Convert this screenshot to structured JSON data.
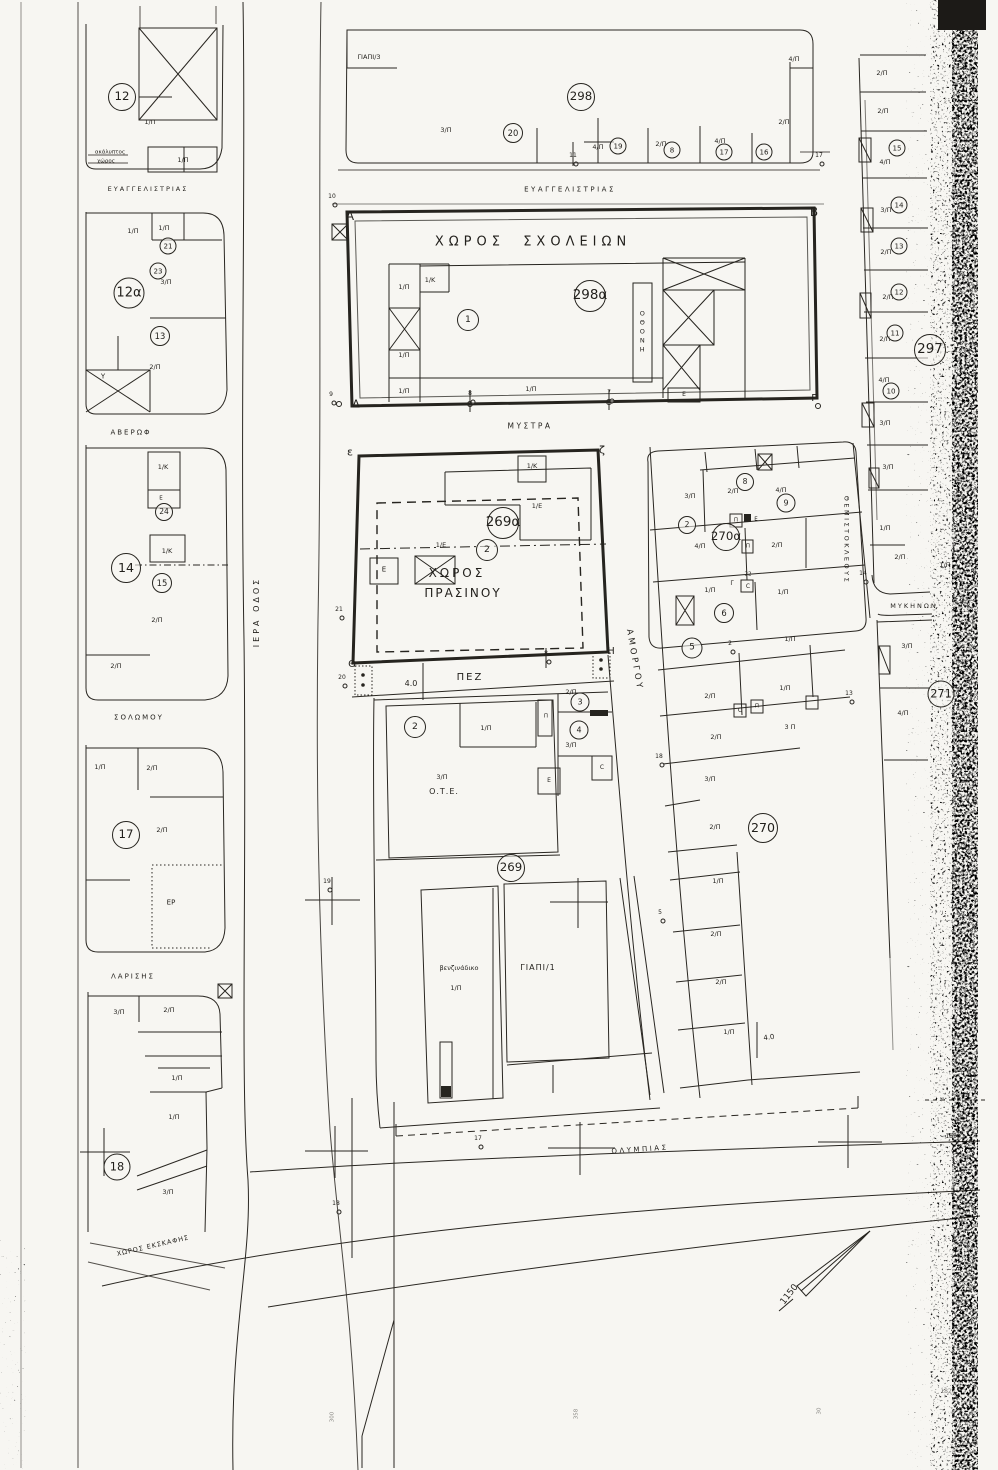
{
  "streets": [
    {
      "n": "street-evangelistrias-west",
      "t": "ΕΥΑΓΓΕΛΙΣΤΡΙΑΣ",
      "x": 148,
      "y": 189,
      "fs": 6.5,
      "ls": 2
    },
    {
      "n": "street-evangelistrias",
      "t": "ΕΥΑΓΓΕΛΙΣΤΡΙΑΣ",
      "x": 570,
      "y": 190,
      "fs": 7,
      "ls": 2.5
    },
    {
      "n": "street-averof",
      "t": "ΑΒΕΡΩΦ",
      "x": 131,
      "y": 433,
      "fs": 7,
      "ls": 2
    },
    {
      "n": "street-iera-odos",
      "t": "ΙΕΡΑ ΟΔΟΣ",
      "x": 257,
      "y": 612,
      "fs": 8,
      "ls": 3,
      "rot": -90
    },
    {
      "n": "street-solomou",
      "t": "ΣΟΛΩΜΟΥ",
      "x": 139,
      "y": 718,
      "fs": 7,
      "ls": 2
    },
    {
      "n": "street-larisis",
      "t": "ΛΑΡΙΣΗΣ",
      "x": 133,
      "y": 977,
      "fs": 7,
      "ls": 2
    },
    {
      "n": "street-mystra",
      "t": "ΜΥΣΤΡΑ",
      "x": 530,
      "y": 426,
      "fs": 7.5,
      "ls": 2.5
    },
    {
      "n": "street-amorgou",
      "t": "ΑΜΟΡΓΟΥ",
      "x": 634,
      "y": 660,
      "fs": 8.5,
      "ls": 3,
      "rot": 80
    },
    {
      "n": "street-themistokleous",
      "t": "ΘΕΜΙΣΤΟΚΛΕΟΥΣ",
      "x": 846,
      "y": 540,
      "fs": 6.5,
      "ls": 2.5,
      "rot": 90
    },
    {
      "n": "street-mykinon",
      "t": "ΜΥΚΗΝΩΝ",
      "x": 914,
      "y": 606,
      "fs": 6.5,
      "ls": 2
    },
    {
      "n": "street-olympias",
      "t": "ΟΛΥΜΠΙΑΣ",
      "x": 640,
      "y": 1150,
      "fs": 7,
      "ls": 2.5,
      "rot": -4
    }
  ],
  "area_labels": [
    {
      "n": "area-school-grounds",
      "t": "ΧΩΡΟΣ  ΣΧΟΛΕΙΩΝ",
      "x": 533,
      "y": 242,
      "fs": 13,
      "ls": 5
    },
    {
      "n": "area-green-space-line1",
      "t": "ΧΩΡΟΣ",
      "x": 457,
      "y": 573,
      "fs": 12,
      "ls": 3
    },
    {
      "n": "area-green-space-line2",
      "t": "ΠΡΑΣΙΝΟΥ",
      "x": 463,
      "y": 593,
      "fs": 12,
      "ls": 2
    },
    {
      "n": "label-ote",
      "t": "Ο.Τ.Ε.",
      "x": 444,
      "y": 792,
      "fs": 8,
      "ls": 1
    },
    {
      "n": "label-gas-station",
      "t": "βενζινάδικο",
      "x": 459,
      "y": 968,
      "fs": 6.5
    },
    {
      "n": "label-giapi-1",
      "t": "ΓΙΑΠΙ/1",
      "x": 538,
      "y": 968,
      "fs": 8,
      "ls": 1
    },
    {
      "n": "label-giapi-3",
      "t": "ΓΙΑΠΙ/3",
      "x": 369,
      "y": 57,
      "fs": 6.5
    },
    {
      "n": "label-pedestrian-way",
      "t": "ΠΕΖ",
      "x": 470,
      "y": 678,
      "fs": 10,
      "ls": 2
    },
    {
      "n": "label-er",
      "t": "ΕΡ",
      "x": 171,
      "y": 903,
      "fs": 7
    },
    {
      "n": "label-uncovered-space-1",
      "t": "ακάλυπτος",
      "x": 110,
      "y": 153,
      "fs": 5.5
    },
    {
      "n": "label-uncovered-space-2",
      "t": "χώρος",
      "x": 106,
      "y": 162,
      "fs": 5.5
    },
    {
      "n": "label-excavation-space",
      "t": "ΧΩΡΟΣ ΕΚΣΚΑΦΗΣ",
      "x": 153,
      "y": 1246,
      "fs": 6.5,
      "rot": -13,
      "ls": 1
    },
    {
      "n": "label-othoni-vertical",
      "t": "ΟΘΟΝΗ",
      "x": 642,
      "y": 332,
      "fs": 6.5,
      "vertical": true
    }
  ],
  "parcel_labels": [
    {
      "t": "1/Π",
      "x": 150,
      "y": 122
    },
    {
      "t": "1/Π",
      "x": 183,
      "y": 160
    },
    {
      "t": "1/Π",
      "x": 133,
      "y": 231
    },
    {
      "t": "1/Π",
      "x": 164,
      "y": 228
    },
    {
      "t": "3/Π",
      "x": 166,
      "y": 282
    },
    {
      "t": "2/Π",
      "x": 155,
      "y": 367
    },
    {
      "t": "1/Κ",
      "x": 163,
      "y": 467
    },
    {
      "t": "1/Κ",
      "x": 167,
      "y": 551
    },
    {
      "t": "2/Π",
      "x": 157,
      "y": 620
    },
    {
      "t": "2/Π",
      "x": 116,
      "y": 666
    },
    {
      "t": "1/Π",
      "x": 100,
      "y": 767
    },
    {
      "t": "2/Π",
      "x": 152,
      "y": 768
    },
    {
      "t": "2/Π",
      "x": 162,
      "y": 830
    },
    {
      "t": "3/Π",
      "x": 119,
      "y": 1012
    },
    {
      "t": "2/Π",
      "x": 169,
      "y": 1010
    },
    {
      "t": "1/Π",
      "x": 177,
      "y": 1078
    },
    {
      "t": "1/Π",
      "x": 174,
      "y": 1117
    },
    {
      "t": "3/Π",
      "x": 168,
      "y": 1192
    },
    {
      "t": "3/Π",
      "x": 446,
      "y": 130
    },
    {
      "t": "4/Π",
      "x": 598,
      "y": 147
    },
    {
      "t": "2/Π",
      "x": 661,
      "y": 144
    },
    {
      "t": "4/Π",
      "x": 720,
      "y": 141
    },
    {
      "t": "2/Π",
      "x": 784,
      "y": 122
    },
    {
      "t": "4/Π",
      "x": 794,
      "y": 59
    },
    {
      "t": "1/Π",
      "x": 404,
      "y": 287
    },
    {
      "t": "1/Κ",
      "x": 430,
      "y": 280
    },
    {
      "t": "1/Π",
      "x": 404,
      "y": 355
    },
    {
      "t": "1/Π",
      "x": 404,
      "y": 391
    },
    {
      "t": "1/Π",
      "x": 531,
      "y": 389
    },
    {
      "t": "1/Κ",
      "x": 532,
      "y": 466
    },
    {
      "t": "1/Ε",
      "x": 537,
      "y": 506
    },
    {
      "t": "1/Ε",
      "x": 441,
      "y": 545
    },
    {
      "t": "1/Π",
      "x": 486,
      "y": 728
    },
    {
      "t": "3/Π",
      "x": 442,
      "y": 777
    },
    {
      "t": "2/Π",
      "x": 571,
      "y": 692
    },
    {
      "t": "3/Π",
      "x": 571,
      "y": 745
    },
    {
      "t": "1/Π",
      "x": 456,
      "y": 988
    },
    {
      "t": "3/Π",
      "x": 690,
      "y": 496
    },
    {
      "t": "2/Π",
      "x": 733,
      "y": 491
    },
    {
      "t": "4/Π",
      "x": 781,
      "y": 490
    },
    {
      "t": "4/Π",
      "x": 700,
      "y": 546
    },
    {
      "t": "2/Π",
      "x": 777,
      "y": 545
    },
    {
      "t": "1/Π",
      "x": 710,
      "y": 590
    },
    {
      "t": "1/Π",
      "x": 783,
      "y": 592
    },
    {
      "t": "1/Π",
      "x": 790,
      "y": 639
    },
    {
      "t": "2/Π",
      "x": 710,
      "y": 696
    },
    {
      "t": "1/Π",
      "x": 785,
      "y": 688
    },
    {
      "t": "3 Π",
      "x": 790,
      "y": 727
    },
    {
      "t": "2/Π",
      "x": 716,
      "y": 737
    },
    {
      "t": "3/Π",
      "x": 710,
      "y": 779
    },
    {
      "t": "2/Π",
      "x": 715,
      "y": 827
    },
    {
      "t": "1/Π",
      "x": 718,
      "y": 881
    },
    {
      "t": "2/Π",
      "x": 716,
      "y": 934
    },
    {
      "t": "2/Π",
      "x": 721,
      "y": 982
    },
    {
      "t": "1/Π",
      "x": 729,
      "y": 1032
    },
    {
      "t": "2/Π",
      "x": 882,
      "y": 73
    },
    {
      "t": "2/Π",
      "x": 883,
      "y": 111
    },
    {
      "t": "4/Π",
      "x": 885,
      "y": 162
    },
    {
      "t": "3/Π",
      "x": 886,
      "y": 210
    },
    {
      "t": "2/Π",
      "x": 886,
      "y": 252
    },
    {
      "t": "2/Π",
      "x": 888,
      "y": 297
    },
    {
      "t": "2/Π",
      "x": 885,
      "y": 339
    },
    {
      "t": "4/Π",
      "x": 884,
      "y": 380
    },
    {
      "t": "3/Π",
      "x": 885,
      "y": 423
    },
    {
      "t": "3/Π",
      "x": 888,
      "y": 467
    },
    {
      "t": "1/Π",
      "x": 885,
      "y": 528
    },
    {
      "t": "2/Π",
      "x": 900,
      "y": 557
    },
    {
      "t": "1/Π",
      "x": 945,
      "y": 565
    },
    {
      "t": "3/Π",
      "x": 907,
      "y": 646
    },
    {
      "t": "4/Π",
      "x": 903,
      "y": 713
    }
  ],
  "corner_letters": [
    {
      "t": "Α",
      "x": 350,
      "y": 216,
      "fs": 12
    },
    {
      "t": "Β",
      "x": 814,
      "y": 212,
      "fs": 12
    },
    {
      "t": "Δ",
      "x": 356,
      "y": 404,
      "fs": 11
    },
    {
      "t": "Γ",
      "x": 814,
      "y": 399,
      "fs": 10
    },
    {
      "t": "ε",
      "x": 350,
      "y": 452,
      "fs": 11
    },
    {
      "t": "ζ",
      "x": 602,
      "y": 450,
      "fs": 11
    },
    {
      "t": "Θ",
      "x": 352,
      "y": 665,
      "fs": 10
    },
    {
      "t": "Η",
      "x": 611,
      "y": 652,
      "fs": 10
    }
  ],
  "misc_labels": [
    {
      "n": "measure-4-0",
      "t": "4.0",
      "x": 411,
      "y": 684,
      "fs": 8
    },
    {
      "n": "measure-4-0-b",
      "t": "4.0",
      "x": 769,
      "y": 1038,
      "fs": 7,
      "rot": -8
    },
    {
      "t": "22",
      "x": 748,
      "y": 575,
      "fs": 5.5
    },
    {
      "t": "C",
      "x": 748,
      "y": 587,
      "fs": 6
    },
    {
      "t": "Υ",
      "x": 103,
      "y": 377,
      "fs": 7
    },
    {
      "t": "Ε",
      "x": 161,
      "y": 499,
      "fs": 5.5
    },
    {
      "t": "Ε",
      "x": 384,
      "y": 570,
      "fs": 7
    },
    {
      "t": "Ε",
      "x": 684,
      "y": 395,
      "fs": 6
    },
    {
      "t": "Π",
      "x": 546,
      "y": 717,
      "fs": 5.5
    },
    {
      "t": "Ε",
      "x": 549,
      "y": 781,
      "fs": 6
    },
    {
      "t": "C",
      "x": 602,
      "y": 768,
      "fs": 6
    },
    {
      "t": "Π",
      "x": 736,
      "y": 521,
      "fs": 5.5
    },
    {
      "t": "Ε",
      "x": 756,
      "y": 520,
      "fs": 5.5
    },
    {
      "t": "Π",
      "x": 748,
      "y": 547,
      "fs": 5.5
    },
    {
      "t": "Γ",
      "x": 732,
      "y": 584,
      "fs": 6
    },
    {
      "t": "C",
      "x": 740,
      "y": 711,
      "fs": 6
    },
    {
      "t": "Π",
      "x": 757,
      "y": 707,
      "fs": 5.5
    },
    {
      "n": "north-arrow-label",
      "t": "1150",
      "x": 790,
      "y": 1295,
      "fs": 9,
      "rot": -52
    },
    {
      "n": "elevation-1850",
      "t": "1850",
      "x": 953,
      "y": 1137,
      "fs": 6
    },
    {
      "n": "elevation-1820",
      "t": "1820",
      "x": 948,
      "y": 1392,
      "fs": 6,
      "faint": true
    },
    {
      "t": "300",
      "x": 333,
      "y": 1417,
      "fs": 5.5,
      "rot": -90,
      "faint": true
    },
    {
      "t": "358",
      "x": 577,
      "y": 1414,
      "fs": 5.5,
      "rot": -90,
      "faint": true
    },
    {
      "t": "30",
      "x": 820,
      "y": 1411,
      "fs": 5.5,
      "rot": -90,
      "faint": true
    }
  ],
  "circled_numbers": [
    {
      "t": "298",
      "x": 581,
      "y": 97,
      "d": 28
    },
    {
      "t": "298α",
      "x": 590,
      "y": 296,
      "d": 32
    },
    {
      "t": "297",
      "x": 930,
      "y": 350,
      "d": 32
    },
    {
      "t": "269α",
      "x": 503,
      "y": 523,
      "d": 32
    },
    {
      "t": "269",
      "x": 511,
      "y": 868,
      "d": 28
    },
    {
      "t": "270α",
      "x": 726,
      "y": 537,
      "d": 28
    },
    {
      "t": "270",
      "x": 763,
      "y": 828,
      "d": 30
    },
    {
      "t": "271",
      "x": 941,
      "y": 694,
      "d": 27
    },
    {
      "t": "12",
      "x": 122,
      "y": 97,
      "d": 28
    },
    {
      "t": "12α",
      "x": 129,
      "y": 293,
      "d": 31
    },
    {
      "t": "13",
      "x": 160,
      "y": 336,
      "d": 20
    },
    {
      "t": "14",
      "x": 126,
      "y": 568,
      "d": 30
    },
    {
      "t": "15",
      "x": 162,
      "y": 583,
      "d": 20
    },
    {
      "t": "17",
      "x": 126,
      "y": 835,
      "d": 28
    },
    {
      "t": "18",
      "x": 117,
      "y": 1167,
      "d": 27
    },
    {
      "t": "24",
      "x": 164,
      "y": 512,
      "d": 18
    },
    {
      "t": "21",
      "x": 168,
      "y": 246,
      "d": 17
    },
    {
      "t": "23",
      "x": 158,
      "y": 271,
      "d": 17
    },
    {
      "t": "20",
      "x": 513,
      "y": 133,
      "d": 20
    },
    {
      "t": "19",
      "x": 618,
      "y": 146,
      "d": 17
    },
    {
      "t": "8",
      "x": 672,
      "y": 150,
      "d": 17
    },
    {
      "t": "17",
      "x": 724,
      "y": 152,
      "d": 17
    },
    {
      "t": "16",
      "x": 764,
      "y": 152,
      "d": 17
    },
    {
      "t": "1",
      "x": 468,
      "y": 320,
      "d": 22
    },
    {
      "t": "2",
      "x": 487,
      "y": 550,
      "d": 22
    },
    {
      "t": "2",
      "x": 415,
      "y": 727,
      "d": 22
    },
    {
      "t": "3",
      "x": 580,
      "y": 702,
      "d": 19
    },
    {
      "t": "4",
      "x": 579,
      "y": 730,
      "d": 19
    },
    {
      "t": "5",
      "x": 692,
      "y": 648,
      "d": 21
    },
    {
      "t": "6",
      "x": 724,
      "y": 613,
      "d": 20
    },
    {
      "t": "2",
      "x": 687,
      "y": 525,
      "d": 18
    },
    {
      "t": "8",
      "x": 745,
      "y": 482,
      "d": 18
    },
    {
      "t": "9",
      "x": 786,
      "y": 503,
      "d": 19
    },
    {
      "t": "10",
      "x": 891,
      "y": 391,
      "d": 17
    },
    {
      "t": "11",
      "x": 895,
      "y": 333,
      "d": 17
    },
    {
      "t": "12",
      "x": 899,
      "y": 292,
      "d": 17
    },
    {
      "t": "13",
      "x": 899,
      "y": 246,
      "d": 17
    },
    {
      "t": "14",
      "x": 899,
      "y": 205,
      "d": 17
    },
    {
      "t": "15",
      "x": 897,
      "y": 148,
      "d": 17
    }
  ],
  "survey_points": [
    {
      "t": "10",
      "x": 332,
      "y": 197
    },
    {
      "t": "9",
      "x": 331,
      "y": 395
    },
    {
      "t": "8",
      "x": 470,
      "y": 394
    },
    {
      "t": "7",
      "x": 609,
      "y": 393
    },
    {
      "t": "17",
      "x": 819,
      "y": 156
    },
    {
      "t": "11",
      "x": 573,
      "y": 156
    },
    {
      "t": "21",
      "x": 339,
      "y": 610
    },
    {
      "t": "20",
      "x": 342,
      "y": 678
    },
    {
      "t": "8",
      "x": 546,
      "y": 654
    },
    {
      "t": "19",
      "x": 327,
      "y": 882
    },
    {
      "t": "18",
      "x": 659,
      "y": 757
    },
    {
      "t": "5",
      "x": 660,
      "y": 913
    },
    {
      "t": "17",
      "x": 478,
      "y": 1139
    },
    {
      "t": "18",
      "x": 336,
      "y": 1204
    },
    {
      "t": "13",
      "x": 849,
      "y": 694
    },
    {
      "t": "14",
      "x": 863,
      "y": 574
    },
    {
      "t": "2",
      "x": 730,
      "y": 644
    }
  ]
}
